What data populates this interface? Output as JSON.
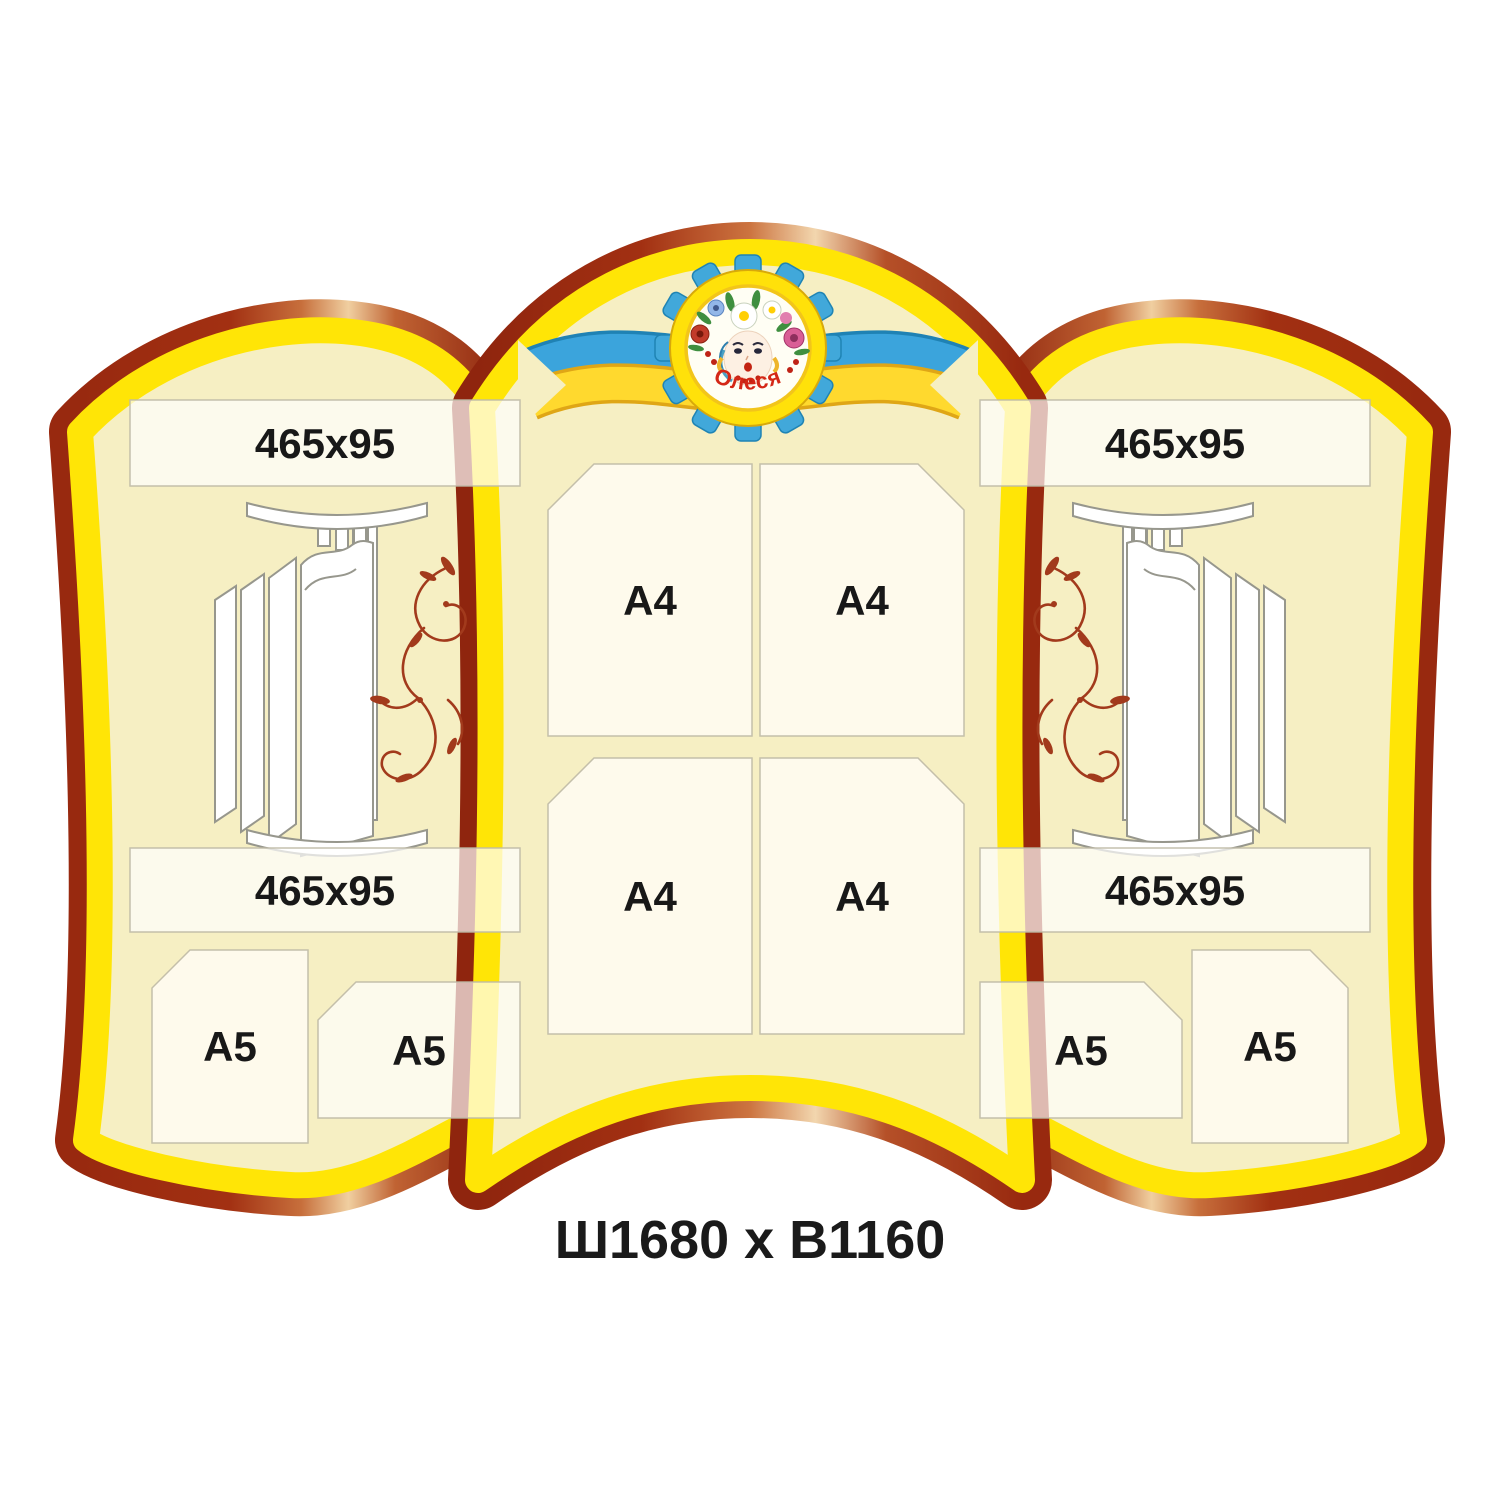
{
  "emblem": {
    "name_text": "Олеся"
  },
  "left_panel": {
    "top_banner_label": "465x95",
    "bottom_banner_label": "465x95",
    "a5_outer_label": "A5",
    "a5_inner_label": "A5"
  },
  "center_panel": {
    "a4_labels": [
      "A4",
      "A4",
      "A4",
      "A4"
    ]
  },
  "right_panel": {
    "top_banner_label": "465x95",
    "bottom_banner_label": "465x95",
    "a5_inner_label": "A5",
    "a5_outer_label": "A5"
  },
  "footer": {
    "dimensions": "Ш1680 х В1160"
  },
  "decor": {
    "emblem_icon": "girl-portrait-flower-wreath-badge",
    "ribbon_icon": "blue-yellow-ribbon",
    "side_graphic": "flip-page-display",
    "side_ornament": "floral-vine-ornament"
  },
  "colors": {
    "frame_red": "#9a2a10",
    "frame_copper": "#f0cfa0",
    "frame_yellow": "#ffe506",
    "panel_cream": "#f6efc3",
    "ornament_red": "#a23a1c",
    "ribbon_blue": "#3ba4dc",
    "ribbon_yellow": "#ffd92e",
    "emblem_ring_yellow": "#ffe10a",
    "emblem_tab_blue": "#41a8da",
    "label_text": "#181818"
  }
}
